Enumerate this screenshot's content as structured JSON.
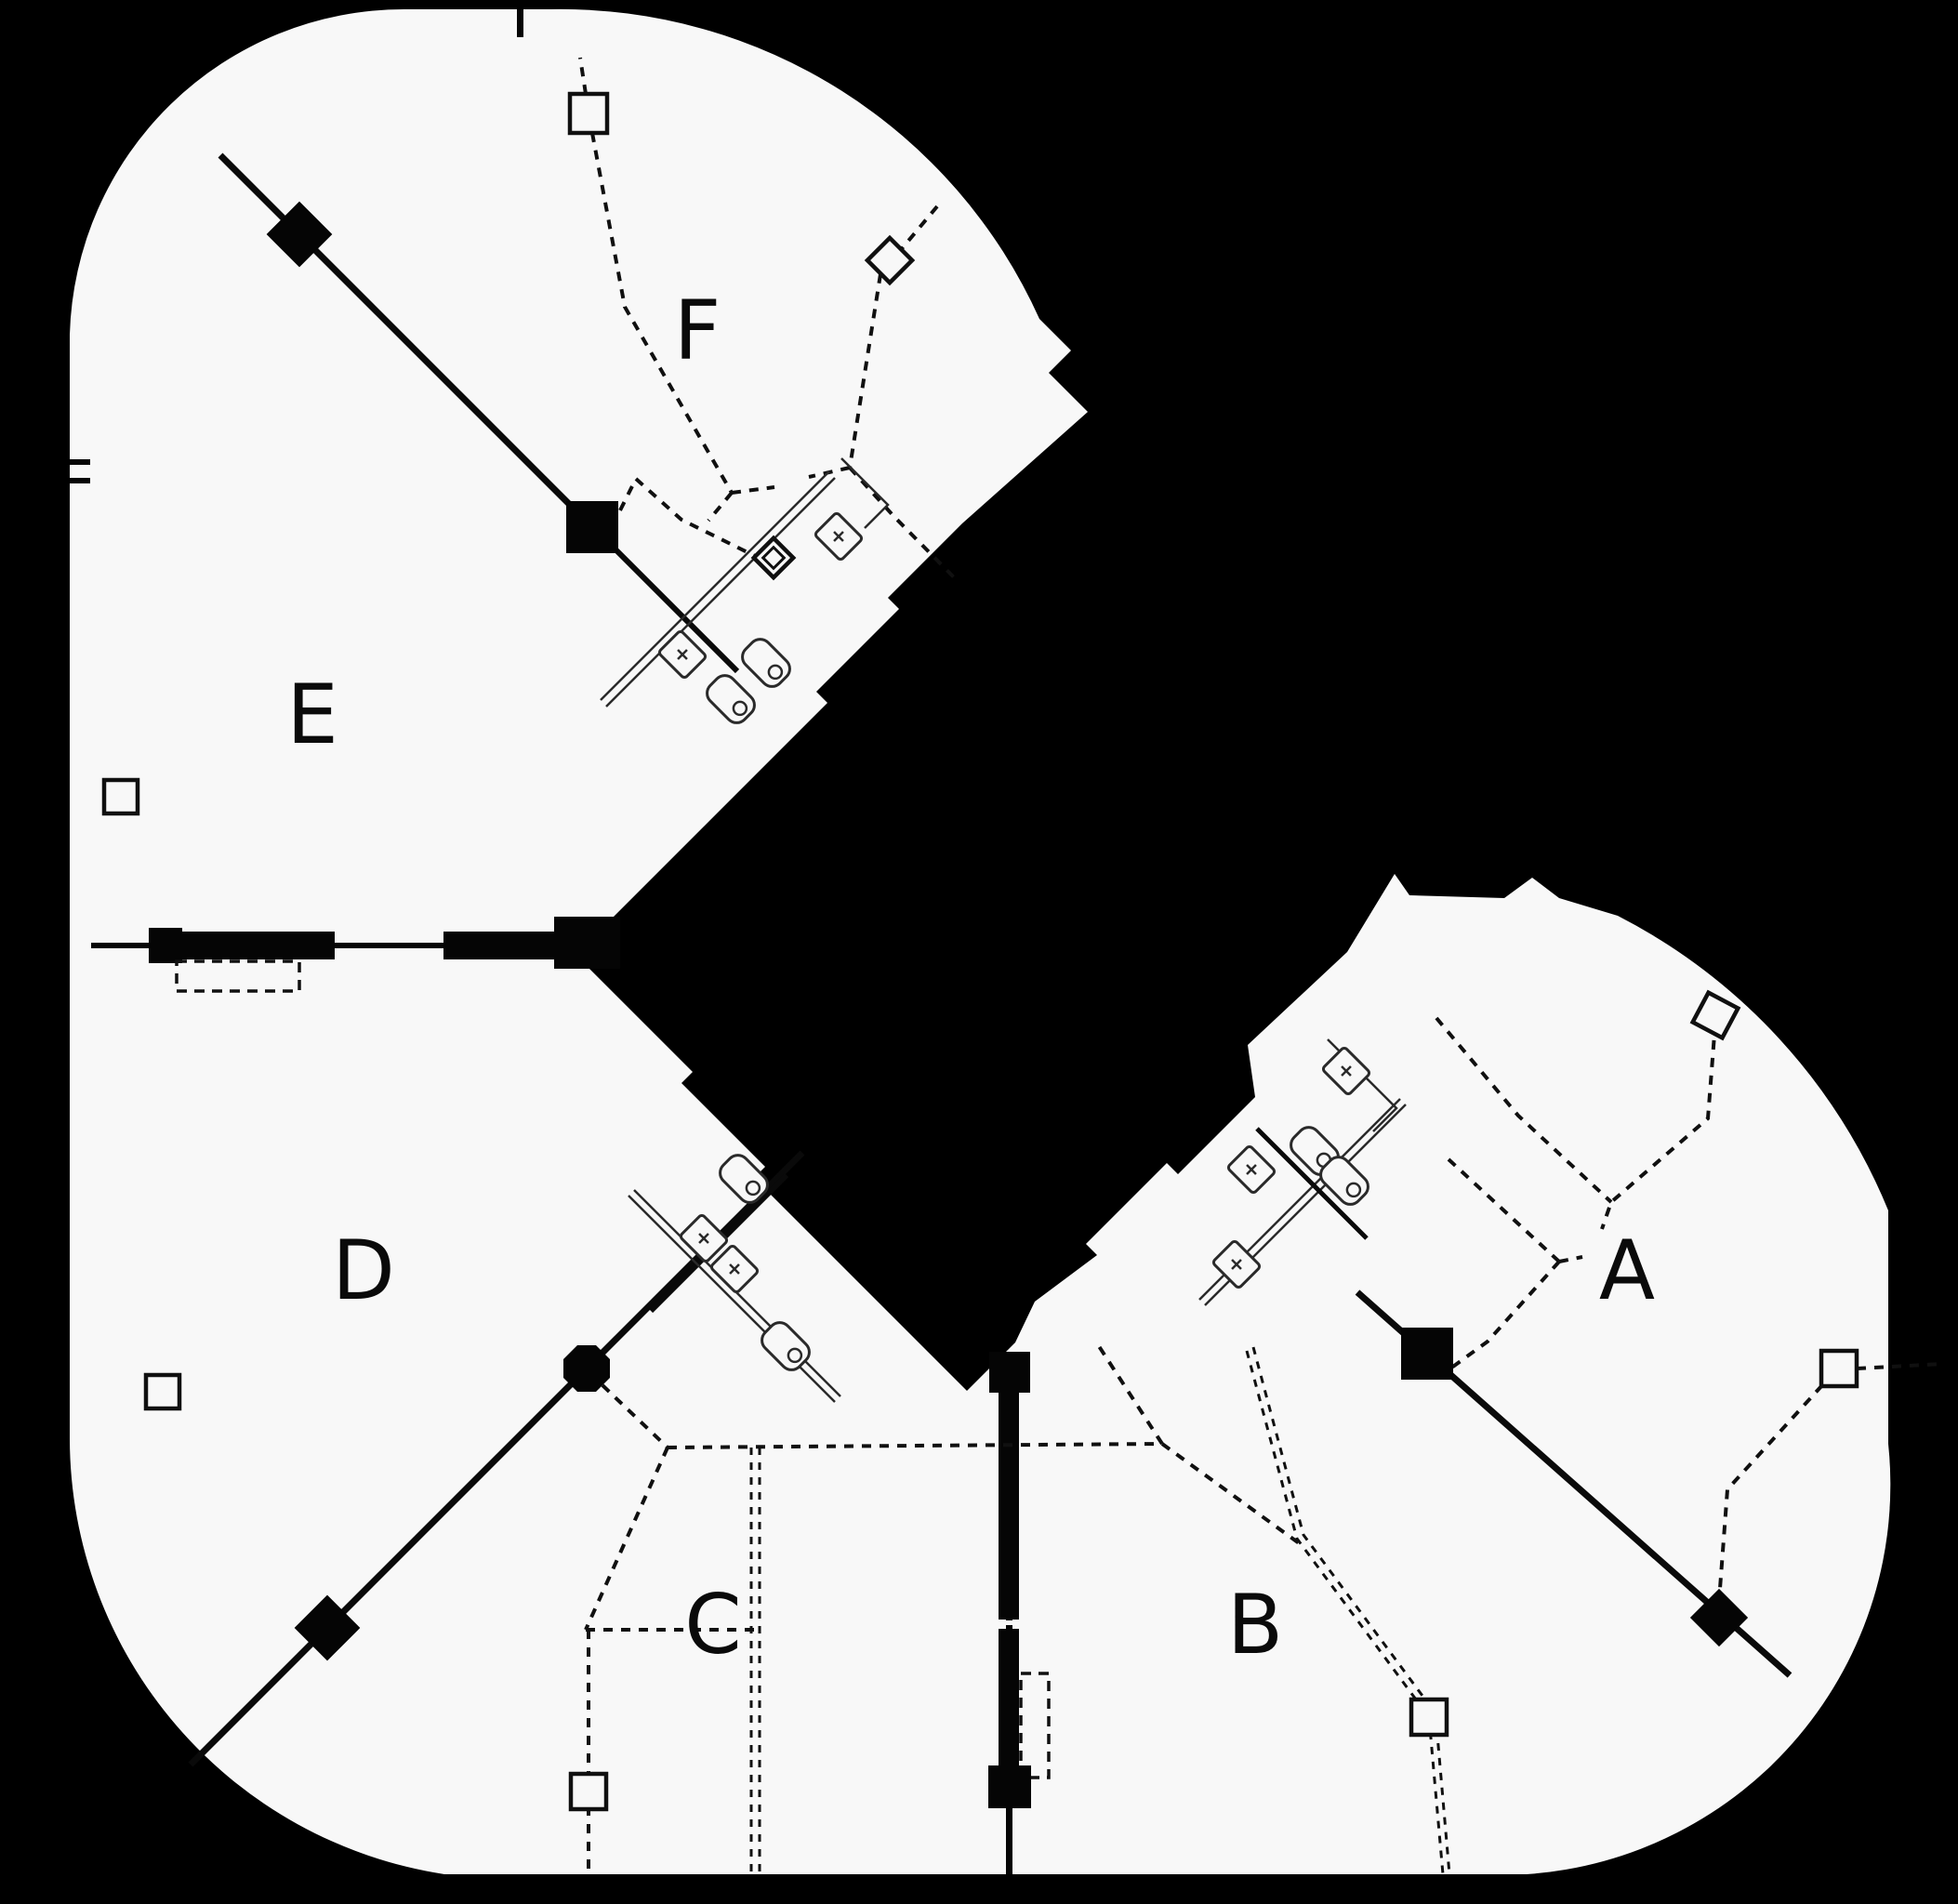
{
  "title": "Tri-wing tower floor plan",
  "colors": {
    "background": "#000000",
    "floor": "#f8f8f8",
    "line": "#0a0a0a"
  },
  "zones": [
    {
      "id": "A",
      "label": "A"
    },
    {
      "id": "B",
      "label": "B"
    },
    {
      "id": "C",
      "label": "C"
    },
    {
      "id": "D",
      "label": "D"
    },
    {
      "id": "E",
      "label": "E"
    },
    {
      "id": "F",
      "label": "F"
    }
  ],
  "features": {
    "core": "solid black central service core with 45-degree jagged poche",
    "restroom_clusters": 3,
    "restroom_fixtures": {
      "sinks": 7,
      "toilets": 6
    },
    "filled_square_nodes": 4,
    "filled_diamond_nodes": 3,
    "octagon_nodes": 1,
    "hollow_square_columns": 6,
    "hollow_diamond_columns": 3,
    "zone_divider_walls": 4,
    "dashed_boundary_lines": "suite demising lines with Y junctions"
  }
}
